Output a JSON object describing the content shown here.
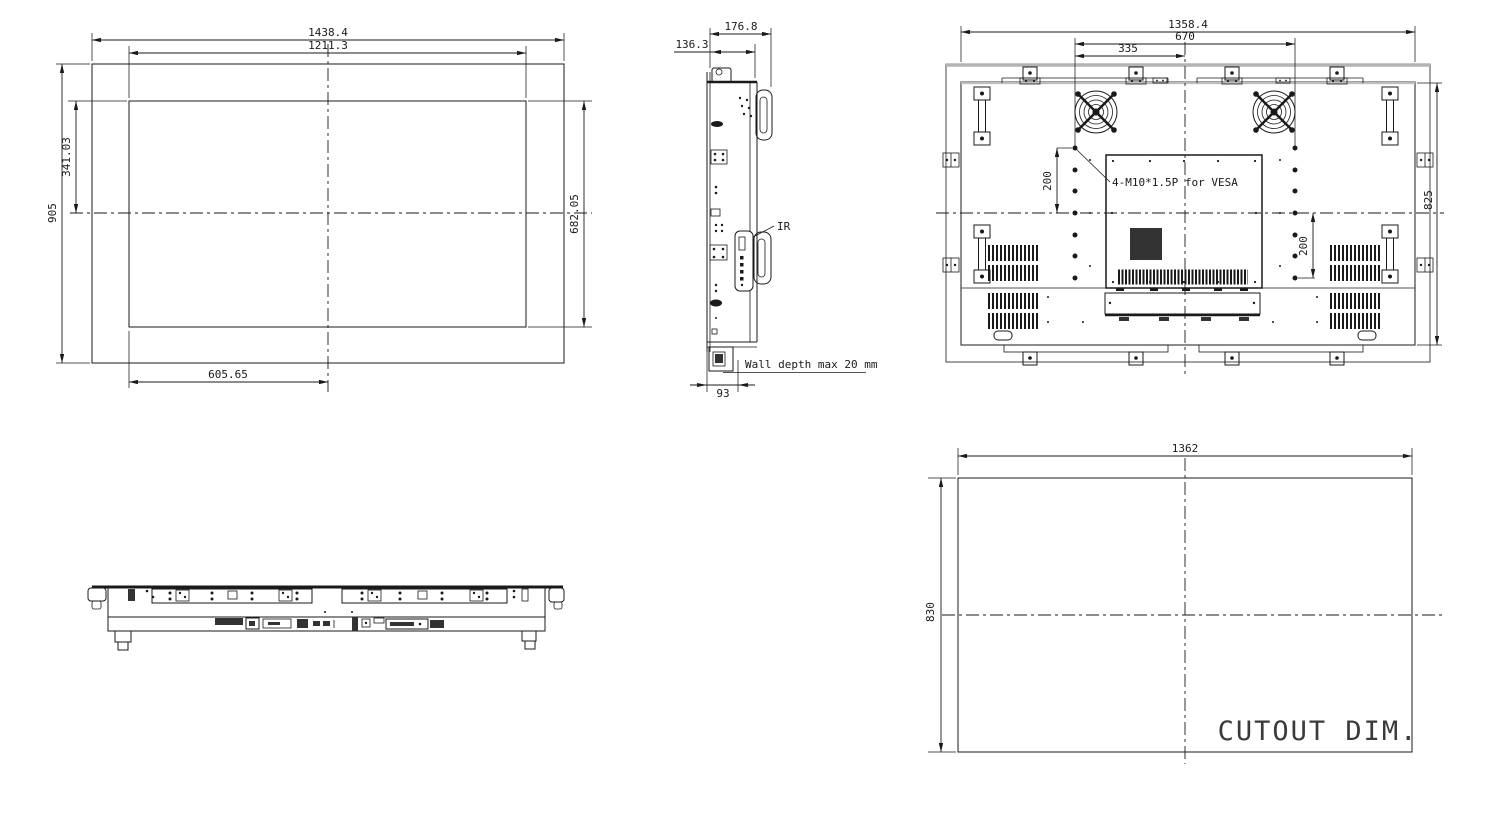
{
  "meta": {
    "background": "#ffffff",
    "line_color": "#1a1a1a"
  },
  "drawing": {
    "front_view": {
      "dims": {
        "overall_width": "1438.4",
        "panel_width": "1211.3",
        "overall_height": "905",
        "half_panel_height": "341.03",
        "panel_height": "682.05",
        "half_panel_width": "605.65"
      }
    },
    "side_view": {
      "dims": {
        "total_depth": "176.8",
        "body_depth": "136.3",
        "mount_depth": "93"
      },
      "labels": {
        "ir": "IR",
        "wall_note": "Wall depth max 20 mm"
      }
    },
    "rear_view": {
      "dims": {
        "body_width": "1358.4",
        "vesa_width": "670",
        "vesa_half_width": "335",
        "vesa_upper": "200",
        "vesa_lower": "200",
        "body_height": "825"
      },
      "labels": {
        "vesa_note": "4-M10*1.5P for VESA"
      }
    },
    "cutout_view": {
      "dims": {
        "width": "1362",
        "height": "830"
      },
      "labels": {
        "title": "CUTOUT DIM."
      }
    }
  }
}
